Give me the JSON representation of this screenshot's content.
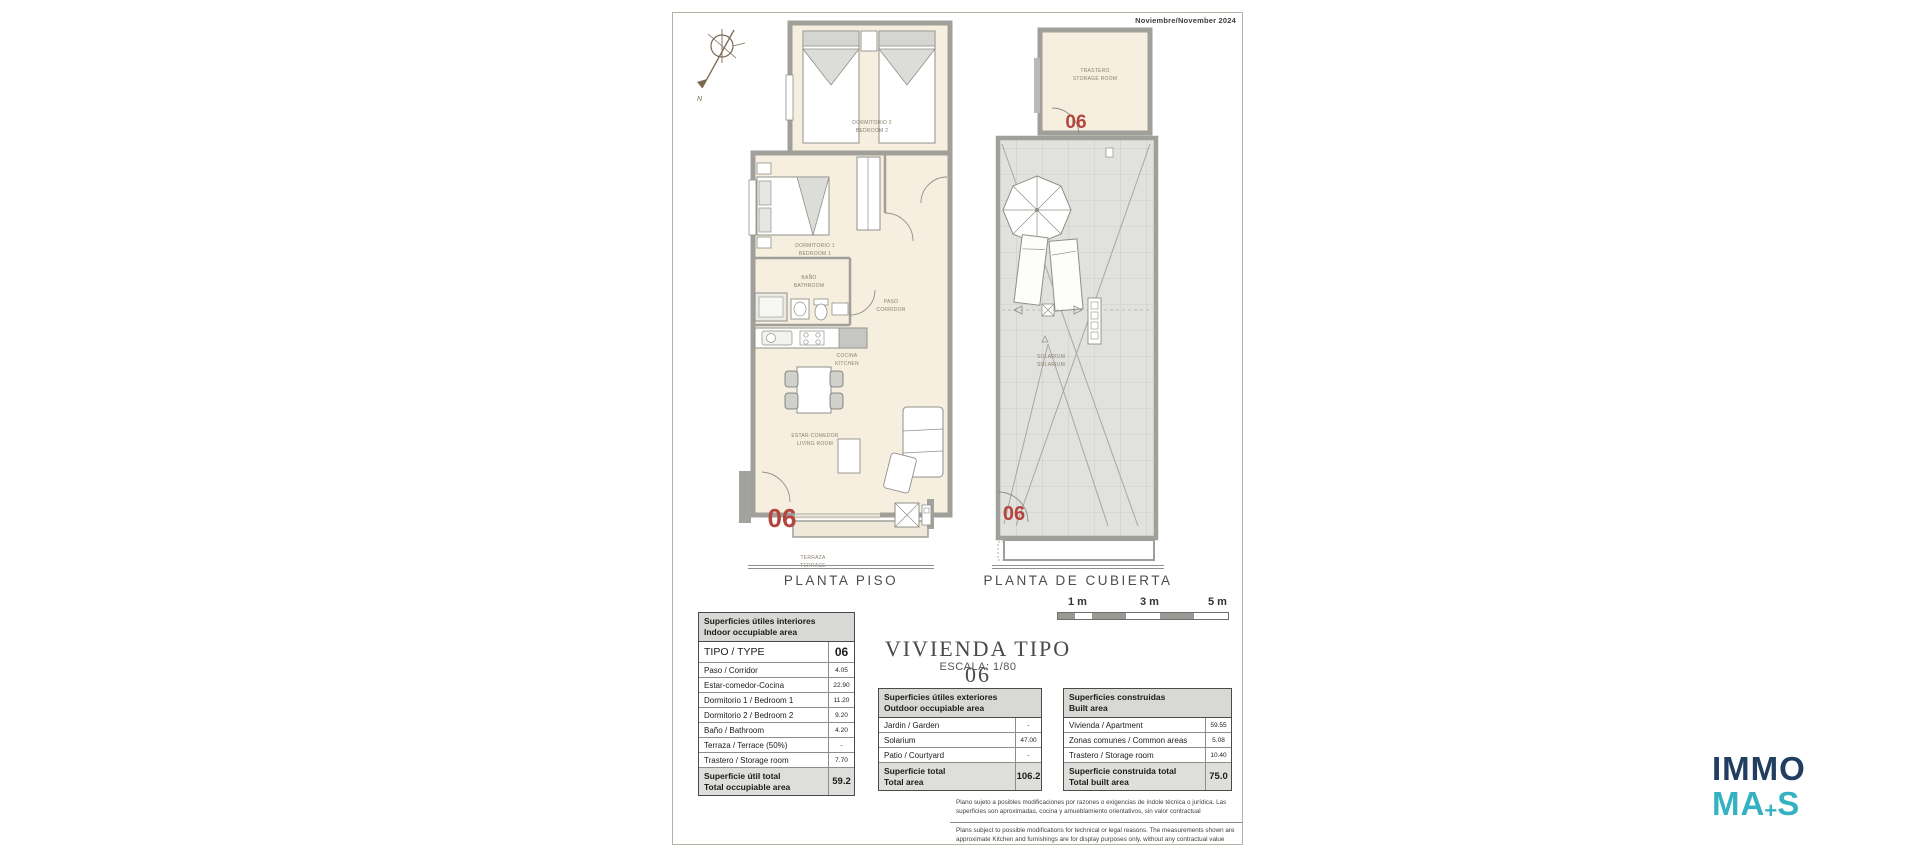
{
  "sheet": {
    "date": "Noviembre/November 2024",
    "north": "N"
  },
  "plan_floor": {
    "caption": "PLANTA PISO",
    "unit": "06",
    "labels": {
      "bedroom2_1": "DORMITORIO 2",
      "bedroom2_2": "BEDROOM 2",
      "bedroom1_1": "DORMITORIO 1",
      "bedroom1_2": "BEDROOM 1",
      "bath_1": "BAÑO",
      "bath_2": "BATHROOM",
      "corridor_1": "PASO",
      "corridor_2": "CORRIDOR",
      "kitchen_1": "COCINA",
      "kitchen_2": "KITCHEN",
      "living_1": "ESTAR-COMEDOR",
      "living_2": "LIVING ROOM",
      "terrace_1": "TERRAZA",
      "terrace_2": "TERRACE"
    }
  },
  "plan_roof": {
    "caption": "PLANTA DE CUBIERTA",
    "unit": "06",
    "labels": {
      "storage_1": "TRASTERO",
      "storage_2": "STORAGE ROOM",
      "solarium_1": "SOLARIUM",
      "solarium_2": "SOLARIUM"
    }
  },
  "title_block": {
    "title": "VIVIENDA TIPO 06",
    "scale": "ESCALA: 1/80",
    "scale_bar": {
      "t1": "1 m",
      "t2": "3 m",
      "t3": "5 m"
    }
  },
  "tables": {
    "interior": {
      "header_1": "Superficies útiles interiores",
      "header_2": "Indoor occupiable area",
      "type_label": "TIPO / TYPE",
      "type_value": "06",
      "rows": [
        {
          "label": "Paso / Corridor",
          "value": "4.05"
        },
        {
          "label": "Estar-comedor-Cocina",
          "value": "22.90"
        },
        {
          "label": "Dormitorio 1 / Bedroom 1",
          "value": "11.20"
        },
        {
          "label": "Dormitorio 2 / Bedroom 2",
          "value": "9.20"
        },
        {
          "label": "Baño / Bathroom",
          "value": "4.20"
        },
        {
          "label": "Terraza / Terrace (50%)",
          "value": "-"
        },
        {
          "label": "Trastero / Storage room",
          "value": "7.70"
        }
      ],
      "total_label_1": "Superficie útil total",
      "total_label_2": "Total occupiable area",
      "total_value": "59.2"
    },
    "exterior": {
      "header_1": "Superficies útiles exteriores",
      "header_2": "Outdoor occupiable area",
      "rows": [
        {
          "label": "Jardin / Garden",
          "value": "-"
        },
        {
          "label": "Solarium",
          "value": "47.00"
        },
        {
          "label": "Patio / Courtyard",
          "value": "-"
        }
      ],
      "total_label_1": "Superficie total",
      "total_label_2": "Total area",
      "total_value": "106.2"
    },
    "built": {
      "header_1": "Superficies construidas",
      "header_2": "Built area",
      "rows": [
        {
          "label": "Vivienda / Apartment",
          "value": "59.55"
        },
        {
          "label": "Zonas comunes / Common areas",
          "value": "5.08"
        },
        {
          "label": "Trastero / Storage room",
          "value": "10.40"
        }
      ],
      "total_label_1": "Superficie construida total",
      "total_label_2": "Total built area",
      "total_value": "75.0"
    }
  },
  "disclaimer": {
    "es": "Plano sujeto a posibles modificaciones por razones o exigencias de índole técnica o jurídica. Las superficies son aproximadas, cocina y amueblamiento  orientativos, sin valor contractual",
    "en": "Plans subject to possible modifications for technical or legal reasons. The measurements shown are approximate Kitchen and furnishings are for display purposes only, without any contractual value"
  },
  "logo": {
    "line1": "IMMO",
    "line2_a": "MA",
    "plus": "+",
    "line2_b": "S"
  },
  "colors": {
    "accent_red": "#b4453e",
    "wall_gray": "#a09f99",
    "floor_cream": "#f6efdf",
    "roof_gray": "#e1e1dd",
    "logo_navy": "#213d5f",
    "logo_teal": "#35b2c2",
    "table_header_bg": "#d8d8d4"
  }
}
